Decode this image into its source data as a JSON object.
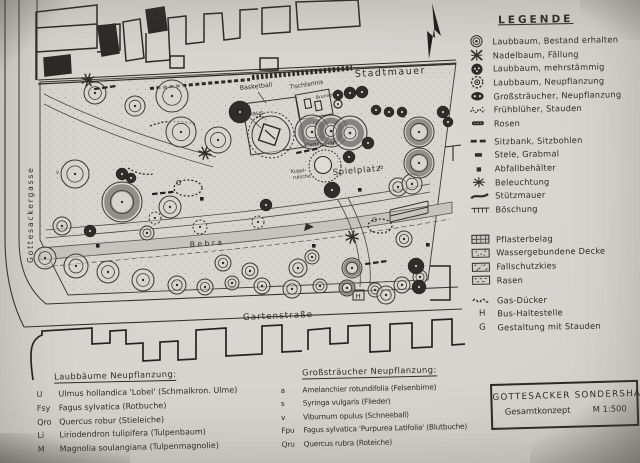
{
  "legend": {
    "heading": "LEGENDE",
    "items": [
      {
        "icon": "laubbaum-bestand-icon",
        "label": "Laubbaum, Bestand erhalten"
      },
      {
        "icon": "nadelbaum-faellung-icon",
        "label": "Nadelbaum, Fällung"
      },
      {
        "icon": "laubbaum-mehrstaemmig-icon",
        "label": "Laubbaum, mehrstämmig"
      },
      {
        "icon": "laubbaum-neupflanzung-icon",
        "label": "Laubbaum, Neupflanzung"
      },
      {
        "icon": "grossstraeucher-neupflanzung-icon",
        "label": "Großsträucher, Neupflanzung"
      },
      {
        "icon": "fruehblueher-stauden-icon",
        "label": "Frühblüher, Stauden"
      },
      {
        "icon": "rosen-icon",
        "label": "Rosen"
      },
      {
        "icon": "sitzbank-icon",
        "label": "Sitzbank, Sitzbohlen"
      },
      {
        "icon": "stele-icon",
        "label": "Stele, Grabmal"
      },
      {
        "icon": "abfallbehaelter-icon",
        "label": "Abfallbehälter"
      },
      {
        "icon": "beleuchtung-icon",
        "label": "Beleuchtung"
      },
      {
        "icon": "stuetzmauer-icon",
        "label": "Stützmauer"
      },
      {
        "icon": "boeschung-icon",
        "label": "Böschung"
      },
      {
        "icon": "pflasterbelag-icon",
        "label": "Pflasterbelag"
      },
      {
        "icon": "wassergebundene-decke-icon",
        "label": "Wassergebundene Decke"
      },
      {
        "icon": "fallschutzkies-icon",
        "label": "Fallschutzkies"
      },
      {
        "icon": "rasen-icon",
        "label": "Rasen"
      },
      {
        "icon": "gas-duecker-icon",
        "label": "Gas-Dücker"
      },
      {
        "symbol": "H",
        "label": "Bus-Haltestelle"
      },
      {
        "symbol": "G",
        "label": "Gestaltung mit Stauden"
      }
    ]
  },
  "plan": {
    "labels": {
      "stadtmauer": "Stadtmauer",
      "gottesackergasse": "Gottesackergasse",
      "gartenstrasse": "Gartenstraße",
      "bebra": "Bebra",
      "spielplatz": "Spielplatz",
      "basketball": "Basketball",
      "tischtennis": "Tischtennis",
      "baumhaus": "Baumhaus",
      "brunnen": "Brunnen",
      "klettergeraet": "Klettergerät",
      "kugelrutsche_1": "Kugel-",
      "kugelrutsche_2": "rutsche",
      "bus_stop": "H",
      "stauden_mark": "G",
      "code_s": "s",
      "code_a": "a",
      "code_v": "v",
      "code_fz": "fz"
    }
  },
  "plant_lists": {
    "trees": {
      "heading": "Laubbäume Neupflanzung:",
      "items": [
        {
          "code": "U",
          "name": "Ulmus hollandica 'Lobel' (Schmalkron. Ulme)"
        },
        {
          "code": "Fsy",
          "name": "Fagus sylvatica (Rotbuche)"
        },
        {
          "code": "Qro",
          "name": "Quercus robur (Stieleiche)"
        },
        {
          "code": "Li",
          "name": "Liriodendron tulipifera (Tulpenbaum)"
        },
        {
          "code": "M",
          "name": "Magnolia soulangiana (Tulpenmagnolie)"
        }
      ]
    },
    "shrubs": {
      "heading": "Großsträucher Neupflanzung:",
      "items": [
        {
          "code": "a",
          "name": "Amelanchier rotundifolia (Felsenbirne)"
        },
        {
          "code": "s",
          "name": "Syringa vulgaris (Flieder)"
        },
        {
          "code": "v",
          "name": "Viburnum opulus (Schneeball)"
        },
        {
          "code": "Fpu",
          "name": "Fagus sylvatica 'Purpurea Latifolia' (Blutbuche)"
        },
        {
          "code": "Qru",
          "name": "Quercus rubra (Roteiche)"
        }
      ]
    }
  },
  "title_block": {
    "project": "GOTTESACKER SONDERSHAUSEN",
    "concept": "Gesamtkonzept",
    "scale": "M 1:500"
  },
  "colors": {
    "paper": "#d5d3ce",
    "ink": "#2e2c29"
  }
}
